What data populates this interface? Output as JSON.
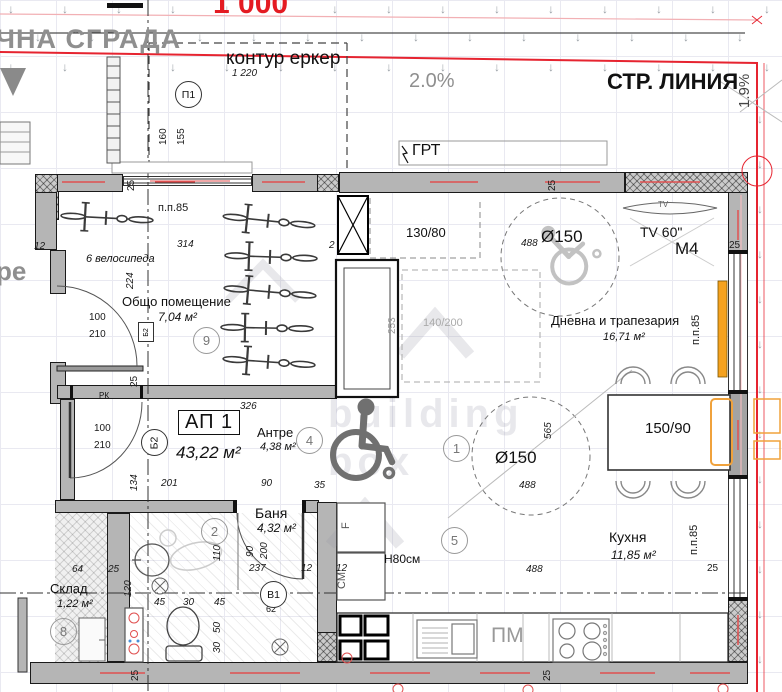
{
  "header": {
    "red_elevation": "1 000",
    "neighbor_label_top": "ЧНА СГРАДА",
    "neighbor_label_left": "ре",
    "bay_contour_label": "контур еркер",
    "slope_left": "2.0%",
    "street_line_label": "СТР. ЛИНИЯ",
    "slope_right": "1.9%",
    "grt_label": "ГРТ"
  },
  "apartment": {
    "id": "АП 1",
    "area": "43,22 м²"
  },
  "rooms": [
    {
      "name": "Общо помещение",
      "area": "7,04 м²",
      "note": "6 велосипеда"
    },
    {
      "name": "Антре",
      "area": "4,38 м²"
    },
    {
      "name": "Баня",
      "area": "4,32 м²"
    },
    {
      "name": "Склад",
      "area": "1,22 м²"
    },
    {
      "name": "Кухня",
      "area": "11,85 м²"
    },
    {
      "name": "Дневна и трапезария",
      "area": "16,71 м²"
    }
  ],
  "equipment": {
    "tv_label": "TV",
    "tv_size": "TV 60\"",
    "m4": "M4",
    "window_niche": "130/80",
    "dining_table": "150/90",
    "turn_circle_1": "Ø150",
    "turn_circle_2": "Ø150",
    "dishwasher": "ПМ",
    "fridge": "F",
    "washer": "СМ",
    "counter_height": "Н80см",
    "hydrant": "РК"
  },
  "axis_markers": {
    "p1": "П1",
    "b2": "Б2",
    "b2_square": "Б2",
    "v1": "В1",
    "v1_offset": "62"
  },
  "position_markers": [
    {
      "t": "9",
      "x": 193,
      "y": 327
    },
    {
      "t": "4",
      "x": 296,
      "y": 427
    },
    {
      "t": "2",
      "x": 201,
      "y": 518
    },
    {
      "t": "1",
      "x": 443,
      "y": 435
    },
    {
      "t": "5",
      "x": 441,
      "y": 527
    },
    {
      "t": "8",
      "x": 50,
      "y": 618
    }
  ],
  "dimensions": [
    {
      "t": "1 220",
      "x": 232,
      "y": 68,
      "i": 1
    },
    {
      "t": "160",
      "x": 169,
      "y": 146,
      "r": 1
    },
    {
      "t": "155",
      "x": 187,
      "y": 146,
      "r": 1
    },
    {
      "t": "п.п.85",
      "x": 158,
      "y": 202,
      "s": 11
    },
    {
      "t": "314",
      "x": 177,
      "y": 239,
      "i": 1
    },
    {
      "t": "12",
      "x": 34,
      "y": 241,
      "i": 1
    },
    {
      "t": "2",
      "x": 329,
      "y": 240,
      "i": 1
    },
    {
      "t": "224",
      "x": 136,
      "y": 290,
      "r": 1,
      "i": 1
    },
    {
      "t": "25",
      "x": 137,
      "y": 192,
      "r": 1
    },
    {
      "t": "25",
      "x": 558,
      "y": 192,
      "r": 1
    },
    {
      "t": "25",
      "x": 729,
      "y": 240
    },
    {
      "t": "100",
      "x": 89,
      "y": 312
    },
    {
      "t": "210",
      "x": 89,
      "y": 329
    },
    {
      "t": "100",
      "x": 94,
      "y": 423
    },
    {
      "t": "210",
      "x": 94,
      "y": 440
    },
    {
      "t": "326",
      "x": 240,
      "y": 401,
      "i": 1
    },
    {
      "t": "201",
      "x": 161,
      "y": 478,
      "i": 1
    },
    {
      "t": "90",
      "x": 261,
      "y": 478,
      "i": 1
    },
    {
      "t": "35",
      "x": 314,
      "y": 480,
      "i": 1
    },
    {
      "t": "134",
      "x": 140,
      "y": 492,
      "r": 1,
      "i": 1
    },
    {
      "t": "25",
      "x": 140,
      "y": 388,
      "r": 1
    },
    {
      "t": "110",
      "x": 223,
      "y": 562,
      "r": 1,
      "i": 1
    },
    {
      "t": "90",
      "x": 256,
      "y": 558,
      "r": 1,
      "i": 1
    },
    {
      "t": "200",
      "x": 270,
      "y": 560,
      "r": 1,
      "i": 1
    },
    {
      "t": "237",
      "x": 249,
      "y": 563,
      "i": 1
    },
    {
      "t": "12",
      "x": 301,
      "y": 563,
      "i": 1
    },
    {
      "t": "12",
      "x": 336,
      "y": 563,
      "i": 1
    },
    {
      "t": "45",
      "x": 154,
      "y": 597,
      "i": 1
    },
    {
      "t": "30",
      "x": 183,
      "y": 597,
      "i": 1
    },
    {
      "t": "45",
      "x": 214,
      "y": 597,
      "i": 1
    },
    {
      "t": "50",
      "x": 223,
      "y": 634,
      "r": 1,
      "i": 1
    },
    {
      "t": "30",
      "x": 223,
      "y": 654,
      "r": 1,
      "i": 1
    },
    {
      "t": "120",
      "x": 134,
      "y": 598,
      "r": 1,
      "i": 1
    },
    {
      "t": "64",
      "x": 72,
      "y": 564,
      "i": 1
    },
    {
      "t": "25",
      "x": 108,
      "y": 564,
      "i": 1
    },
    {
      "t": "488",
      "x": 521,
      "y": 238,
      "i": 1
    },
    {
      "t": "488",
      "x": 519,
      "y": 480,
      "i": 1
    },
    {
      "t": "565",
      "x": 554,
      "y": 440,
      "r": 1,
      "i": 1
    },
    {
      "t": "488",
      "x": 526,
      "y": 564,
      "i": 1
    },
    {
      "t": "25",
      "x": 707,
      "y": 563
    },
    {
      "t": "п.п.85",
      "x": 702,
      "y": 345,
      "r": 1,
      "s": 11
    },
    {
      "t": "п.п.85",
      "x": 700,
      "y": 555,
      "r": 1,
      "s": 11
    },
    {
      "t": "253",
      "x": 398,
      "y": 335,
      "r": 1,
      "c": "#999999"
    },
    {
      "t": "140/200",
      "x": 423,
      "y": 317,
      "c": "#aaaaaa",
      "s": 11
    },
    {
      "t": "25",
      "x": 553,
      "y": 682,
      "r": 1
    },
    {
      "t": "25",
      "x": 141,
      "y": 682,
      "r": 1
    }
  ],
  "watermark": {
    "word1": "building",
    "word2": "box"
  },
  "colors": {
    "wall": "#b5b5b5",
    "accent_red": "#e62430",
    "orange": "#f5a21f",
    "grid": "#e9e9f1"
  }
}
